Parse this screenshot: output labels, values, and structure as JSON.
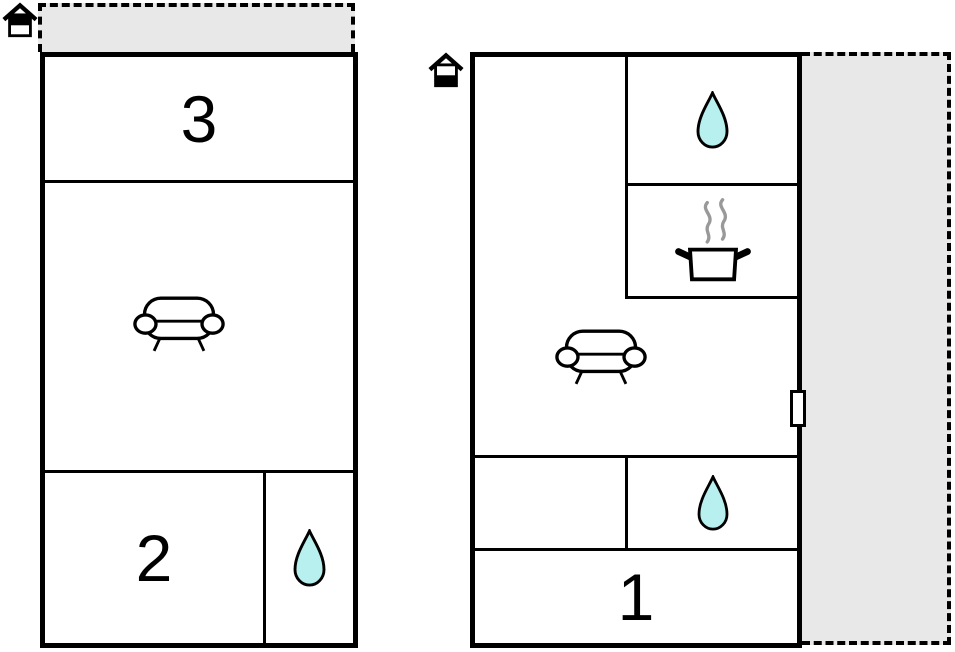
{
  "colors": {
    "wall": "#000000",
    "terrace_fill": "#e8e8e8",
    "water_drop_fill": "#b8f0ef",
    "steam": "#999999",
    "background": "#ffffff"
  },
  "labels": {
    "room1": "1",
    "room2": "2",
    "room3": "3"
  },
  "units": {
    "left": {
      "floor_icon": "upper-floor-house-icon",
      "terrace_position": "top",
      "rooms": [
        {
          "label": "3"
        },
        {
          "icon": "sofa-icon"
        },
        {
          "label": "2"
        },
        {
          "icon": "water-drop-icon"
        }
      ]
    },
    "right": {
      "floor_icon": "ground-floor-house-icon",
      "terrace_position": "right",
      "door_position": "right-wall",
      "rooms": [
        {
          "icon": "water-drop-icon"
        },
        {
          "icon": "cooking-pot-icon"
        },
        {
          "icon": "sofa-icon"
        },
        {
          "icon": "water-drop-icon"
        },
        {
          "label": "1"
        }
      ]
    }
  }
}
